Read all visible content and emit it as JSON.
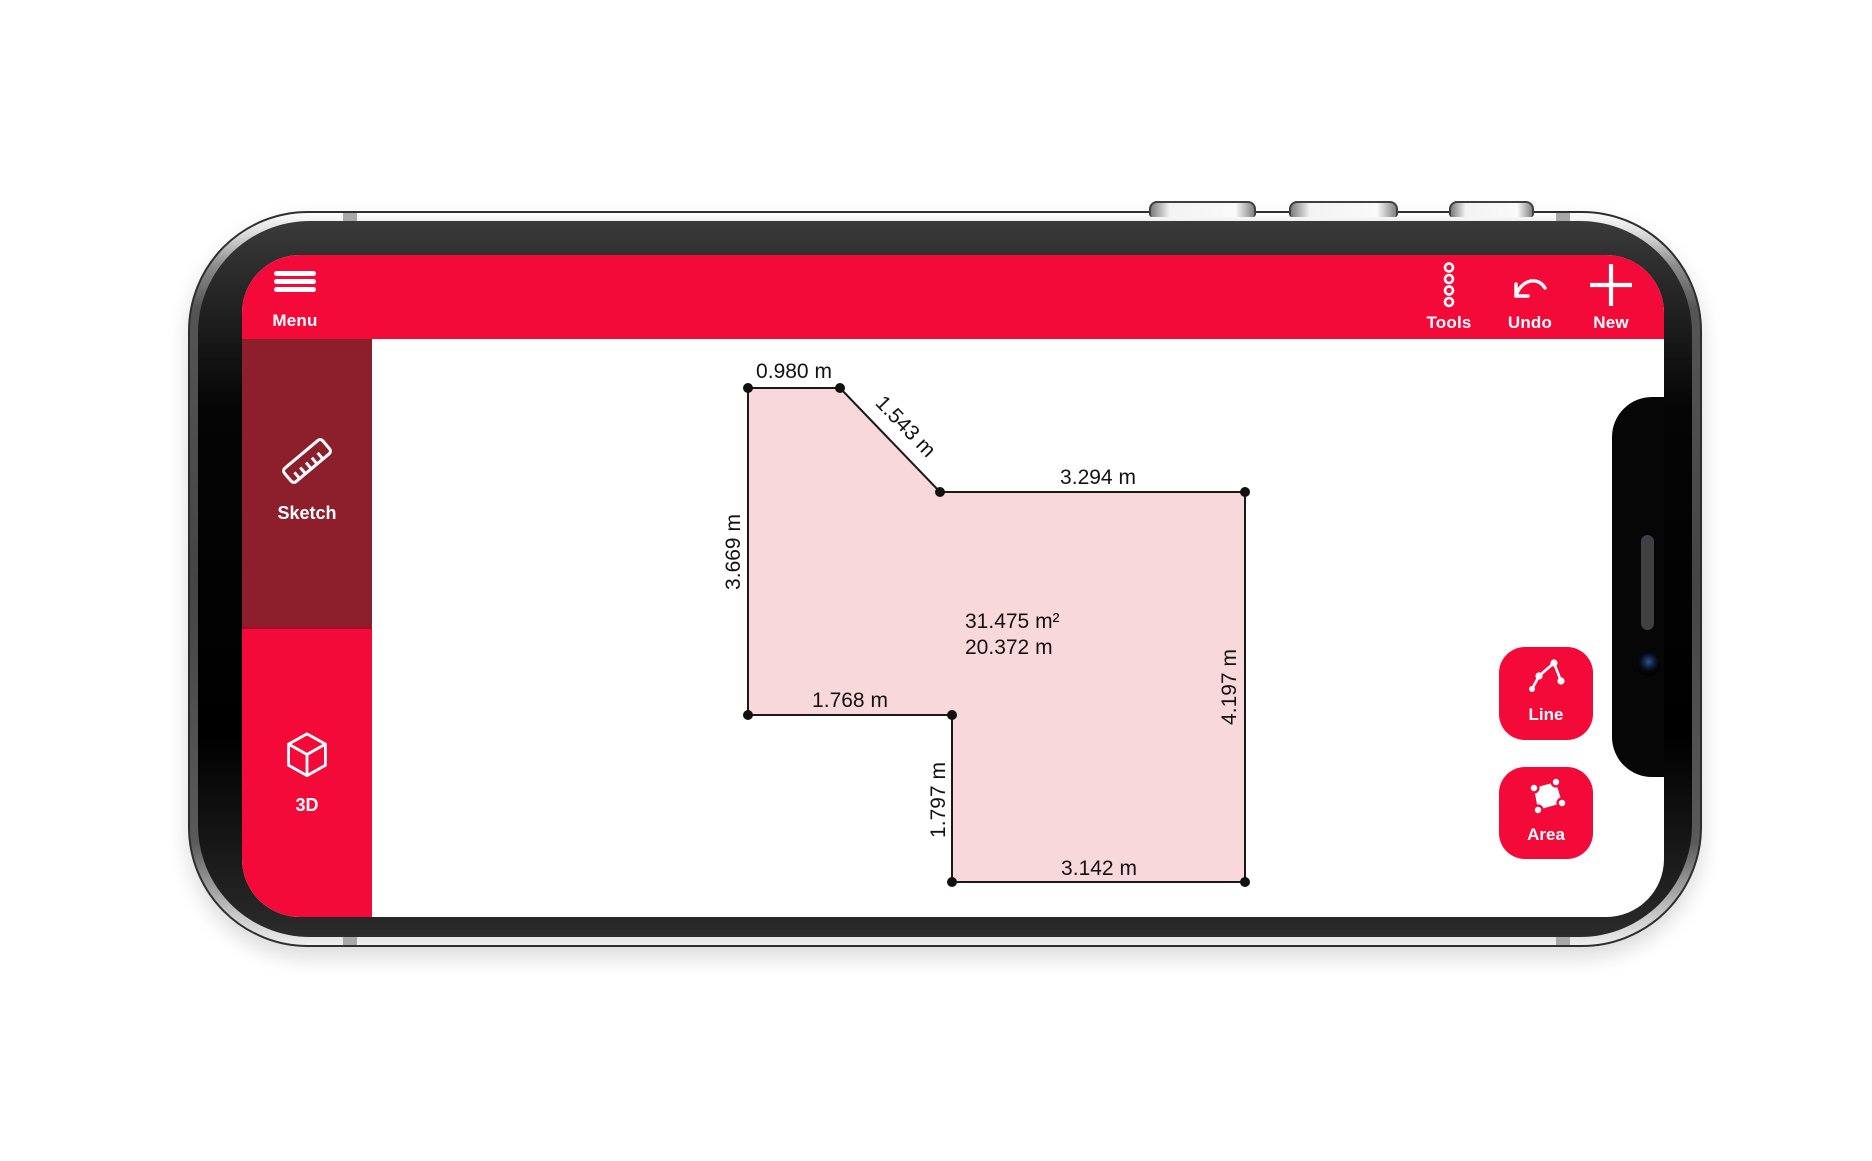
{
  "phone": {
    "hardware": {
      "top_buttons": [
        "volume-up",
        "volume-down",
        "power"
      ],
      "notch_parts": [
        "speaker",
        "camera"
      ]
    }
  },
  "app": {
    "colors": {
      "accent_red": "#f40a38",
      "sidebar_dark_red": "#8d1f2d",
      "sketch_fill": "#f9d8db",
      "sketch_stroke": "#1a1a1a",
      "text_dark": "#121212",
      "text_light": "#ffffff"
    },
    "header": {
      "menu": {
        "label": "Menu",
        "icon": "hamburger-icon"
      },
      "actions": [
        {
          "label": "Tools",
          "icon": "kebab-dots-icon"
        },
        {
          "label": "Undo",
          "icon": "undo-arrow-icon"
        },
        {
          "label": "New",
          "icon": "plus-icon"
        }
      ]
    },
    "sidebar": {
      "items": [
        {
          "label": "Sketch",
          "icon": "ruler-icon",
          "active": true
        },
        {
          "label": "3D",
          "icon": "cube-icon",
          "active": false
        }
      ]
    },
    "fabs": [
      {
        "label": "Line",
        "icon": "polyline-icon"
      },
      {
        "label": "Area",
        "icon": "polygon-icon"
      }
    ],
    "sketch": {
      "summary": {
        "area": "31.475 m²",
        "perimeter": "20.372 m"
      },
      "edge_labels": [
        "0.980 m",
        "1.543 m",
        "3.294 m",
        "3.669 m",
        "4.197 m",
        "1.768 m",
        "1.797 m",
        "3.142 m"
      ]
    }
  }
}
